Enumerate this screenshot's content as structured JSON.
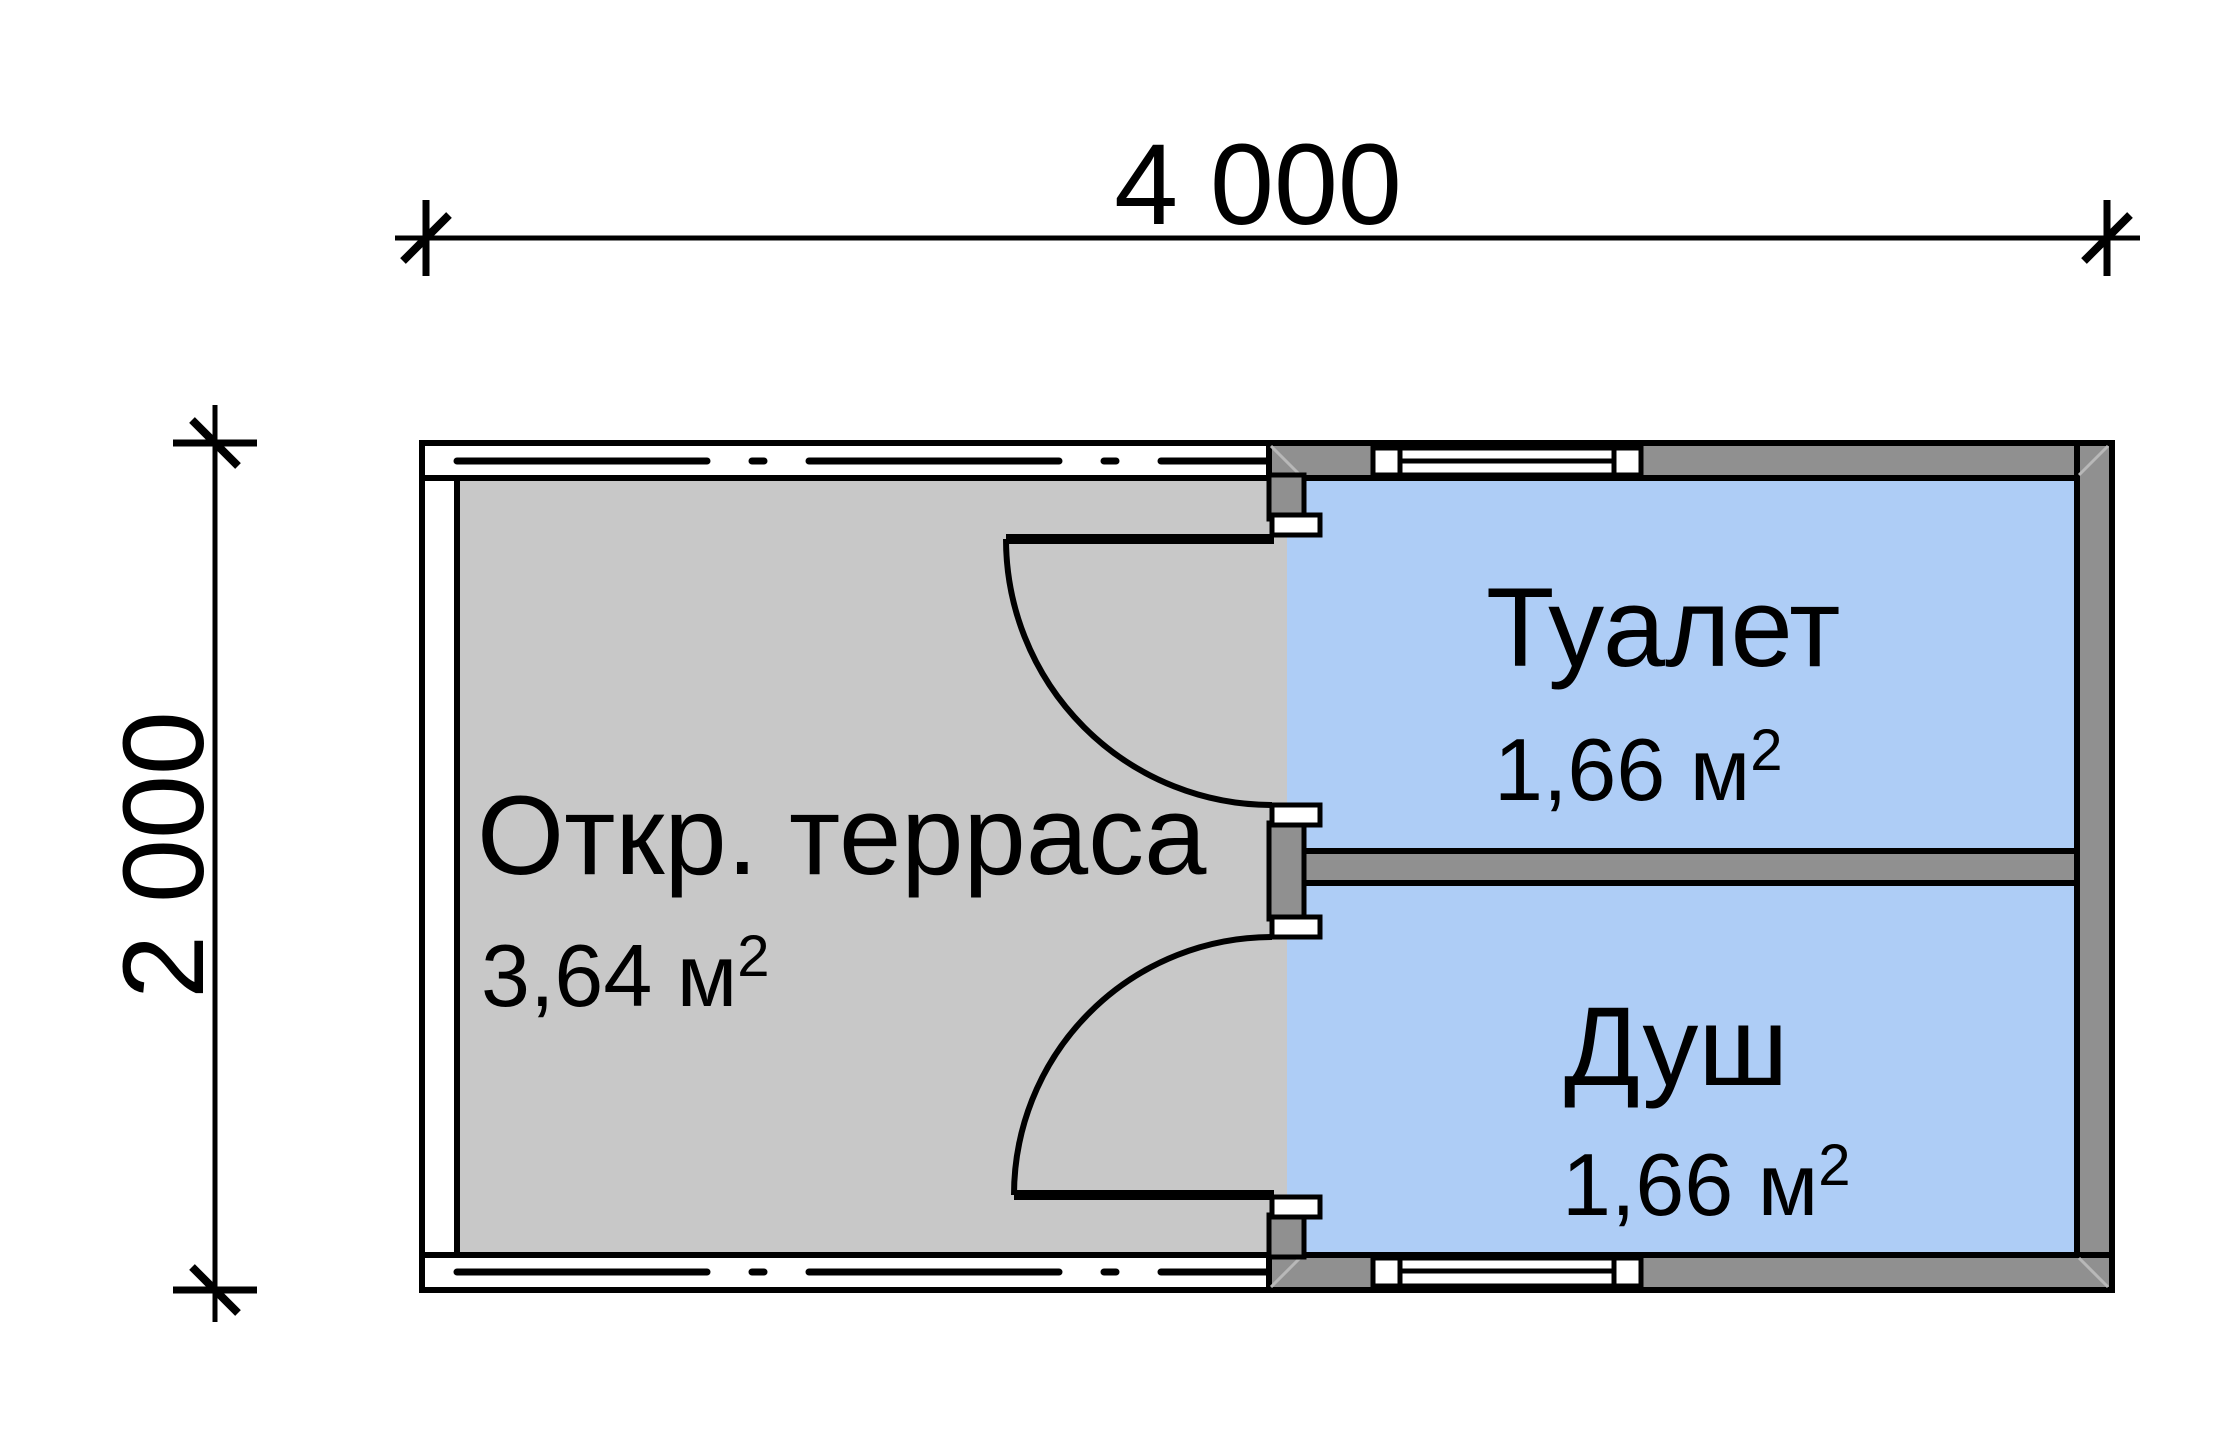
{
  "dimensions": {
    "width": {
      "label": "4 000"
    },
    "height": {
      "label": "2 000"
    }
  },
  "rooms": [
    {
      "id": "terrace",
      "name": "Откр. терраса",
      "area": "3,64 м",
      "area_sup": "2"
    },
    {
      "id": "toilet",
      "name": "Туалет",
      "area": "1,66 м",
      "area_sup": "2"
    },
    {
      "id": "shower",
      "name": "Душ",
      "area": "1,66 м",
      "area_sup": "2"
    }
  ],
  "colors": {
    "background": "#ffffff",
    "terrace_fill": "#c8c8c8",
    "room_fill": "#aecdf6",
    "wall_fill": "#909090",
    "door_stop_fill": "#ffffff",
    "band_fill": "#ffffff",
    "line": "#000000"
  }
}
